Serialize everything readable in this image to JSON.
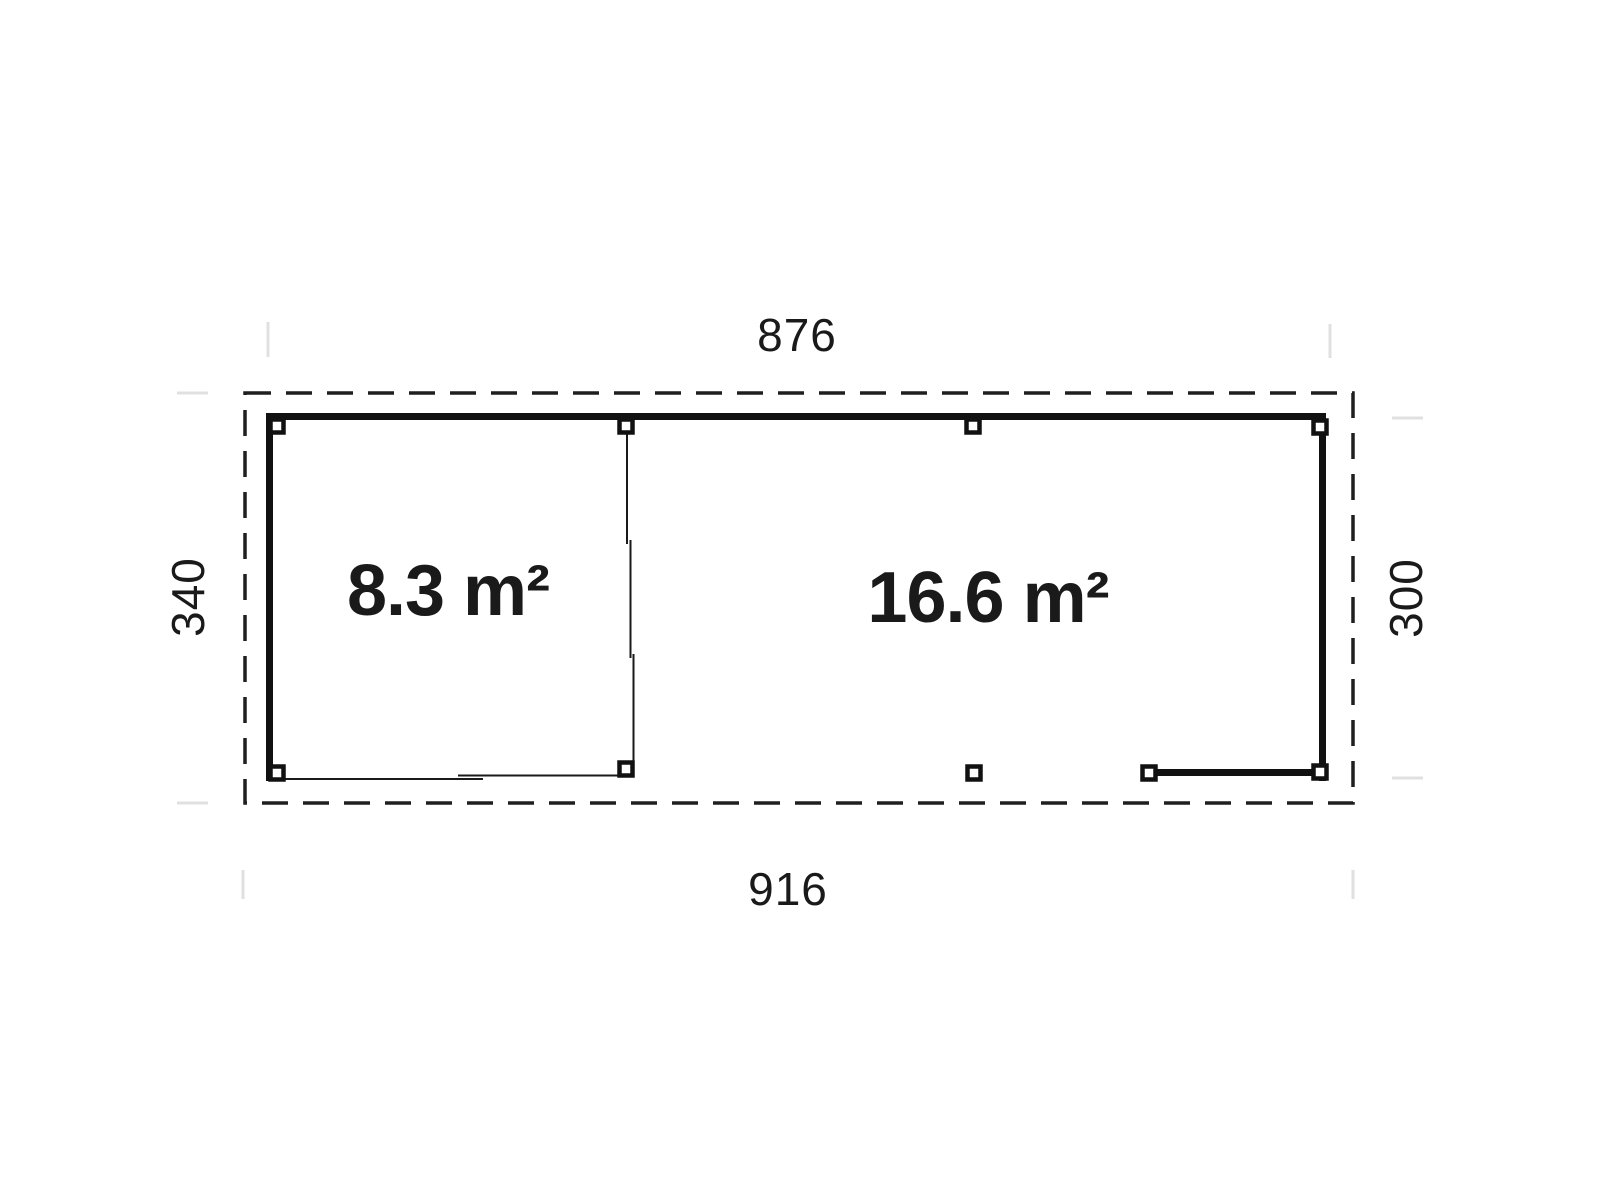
{
  "plan": {
    "type": "floor-plan",
    "dimensions": {
      "top_width": "876",
      "bottom_width": "916",
      "left_depth": "340",
      "right_depth": "300"
    },
    "rooms": {
      "left_area": "8.3 m²",
      "right_area": "16.6 m²"
    },
    "colors": {
      "ink": "#1a1a1a",
      "wall": "#111111",
      "faint_tick": "#e0e0e0",
      "background": "#ffffff"
    }
  }
}
